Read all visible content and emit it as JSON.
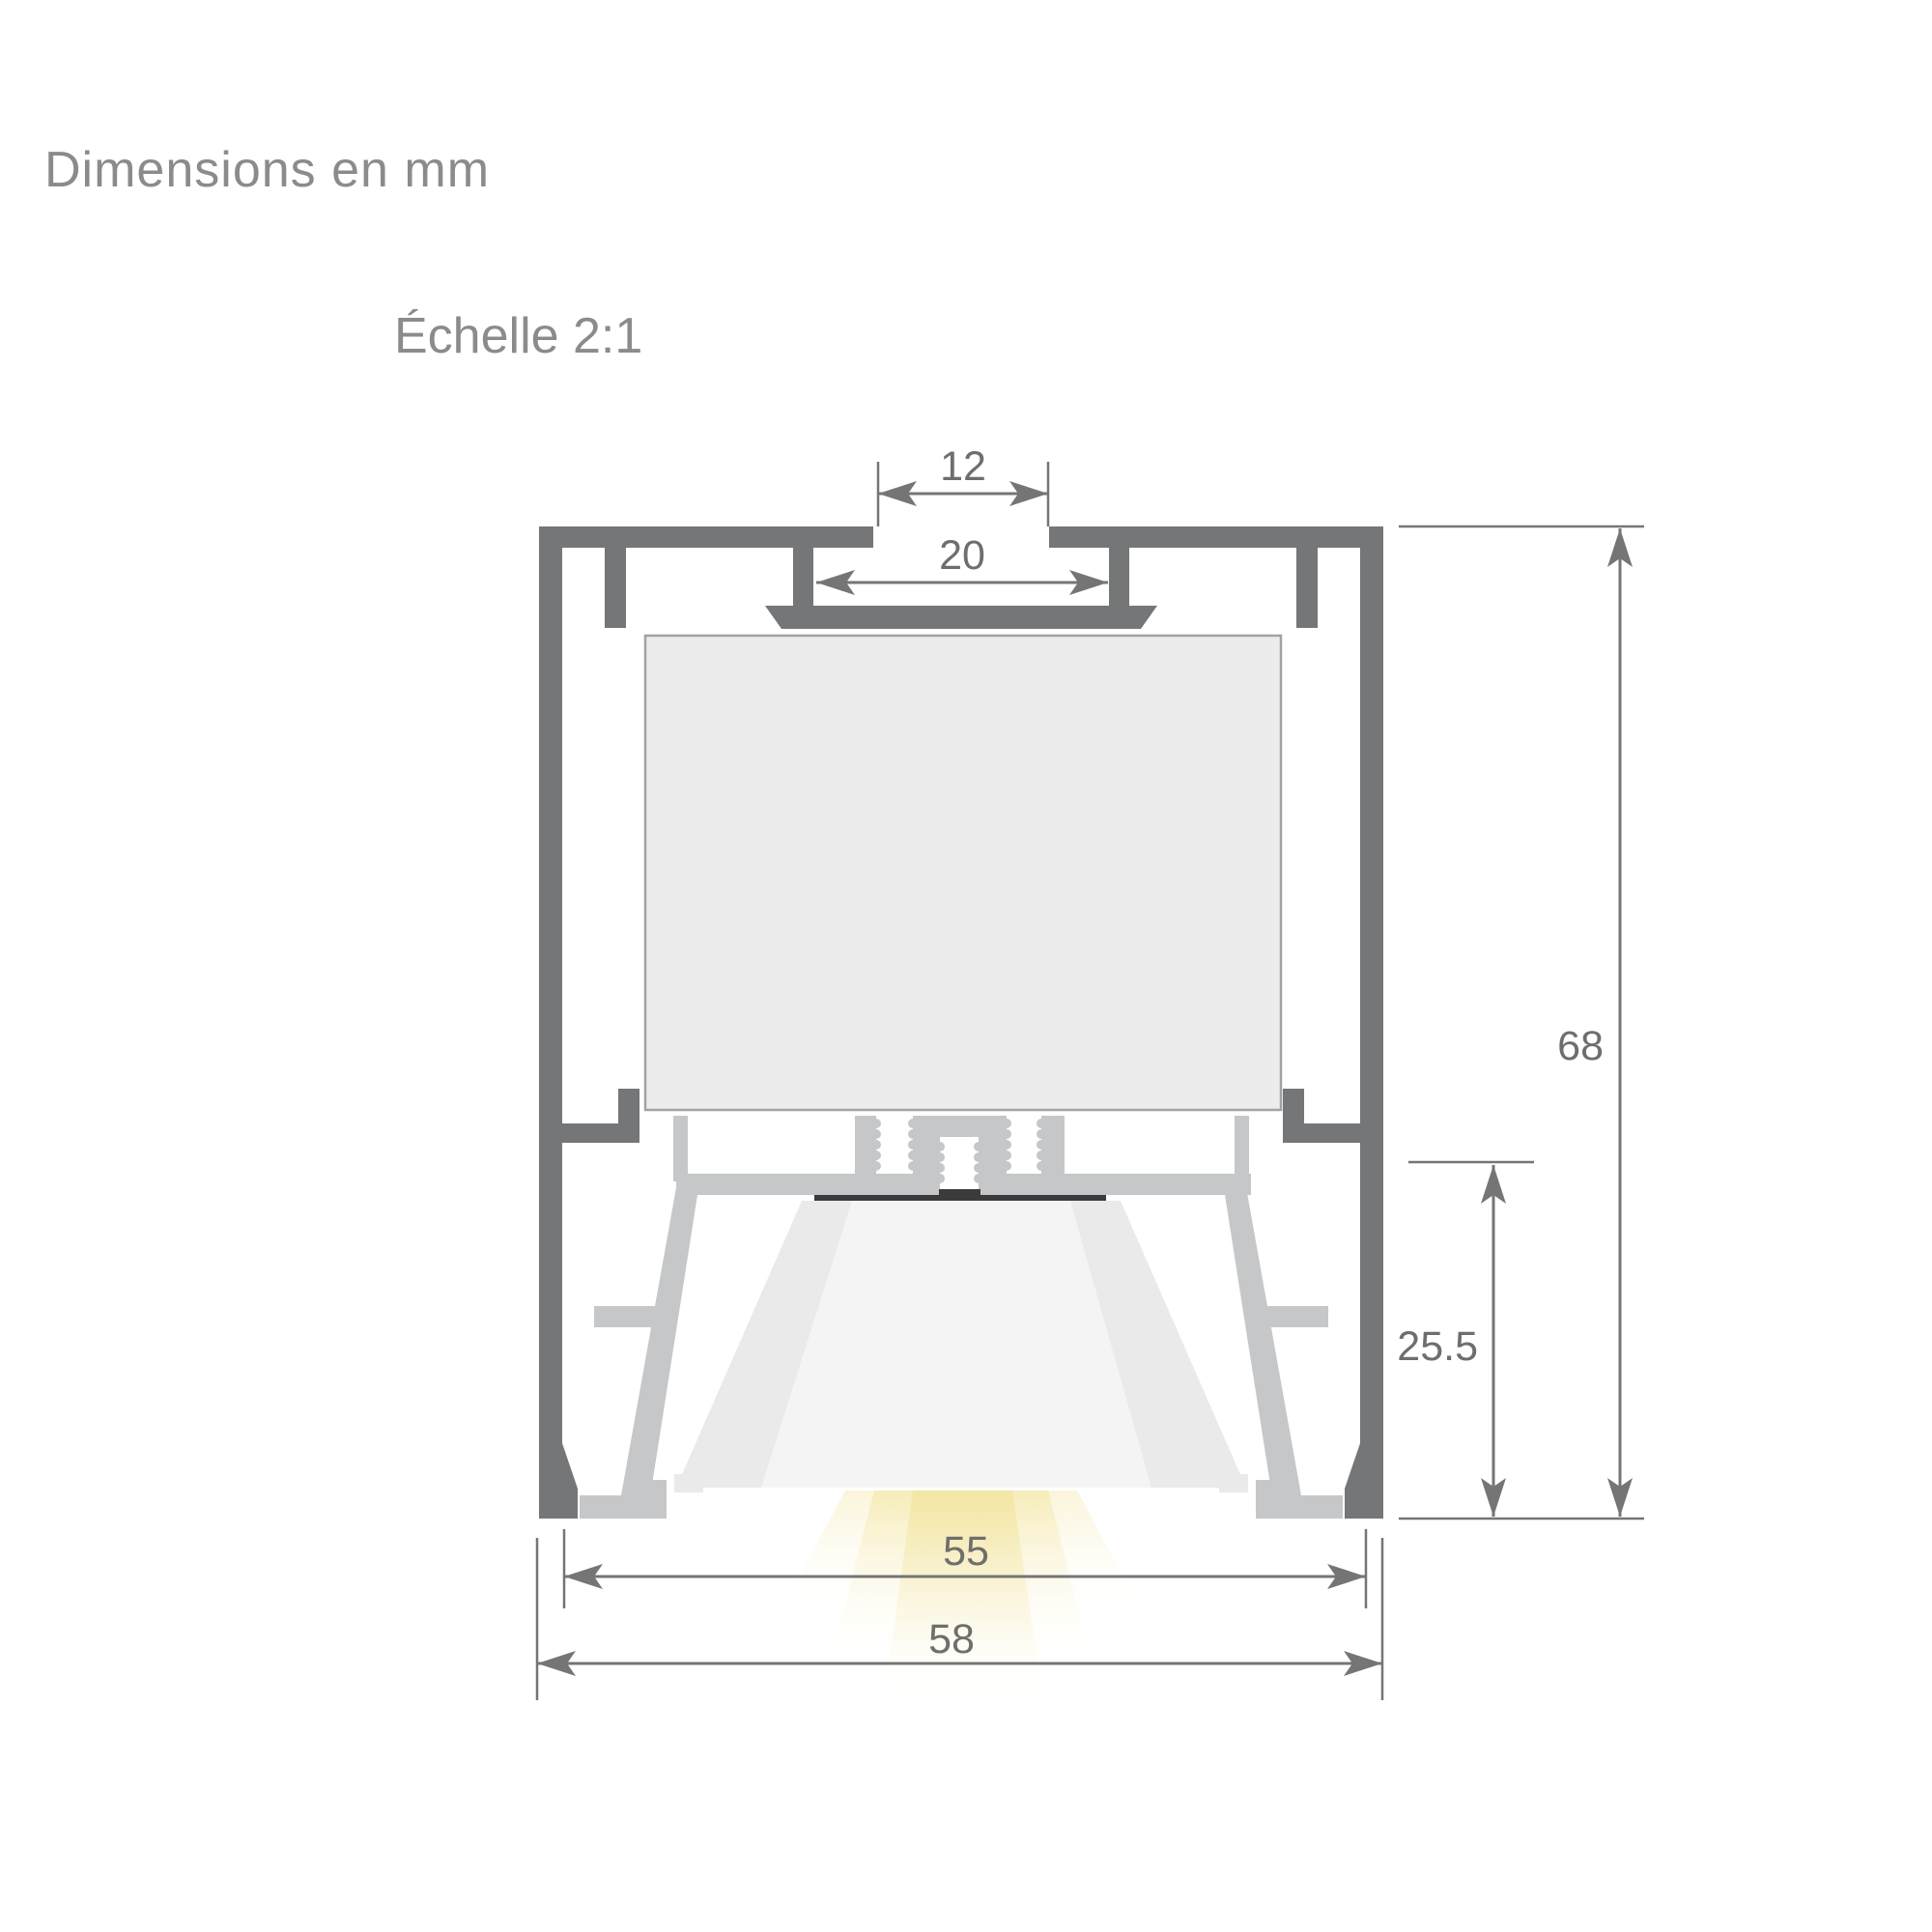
{
  "page": {
    "title": "Dimensions en mm",
    "scale_note": "Échelle 2:1"
  },
  "drawing": {
    "type": "technical-cross-section",
    "subject": "LED aluminium profile cross-section",
    "units": "mm",
    "scale": "2:1",
    "dimensions": {
      "top_slot_opening": "12",
      "top_slot_channel": "20",
      "overall_height": "68",
      "light_chamber_height": "25.5",
      "inner_width": "55",
      "overall_width": "58"
    },
    "colors": {
      "background": "#ffffff",
      "profile": "#757677",
      "metal": "#c6c7c8",
      "panel": "#ececec",
      "panel_border": "#a2a2a2",
      "diffuser": "#eaeaea",
      "diffuser_highlight": "#f4f4f4",
      "led_strip": "#3b3b3b",
      "dim_line": "#757575",
      "dim_text": "#6e6e6e",
      "heading_text": "#8b8b8b",
      "light_beam": "#f3e5a0"
    }
  }
}
